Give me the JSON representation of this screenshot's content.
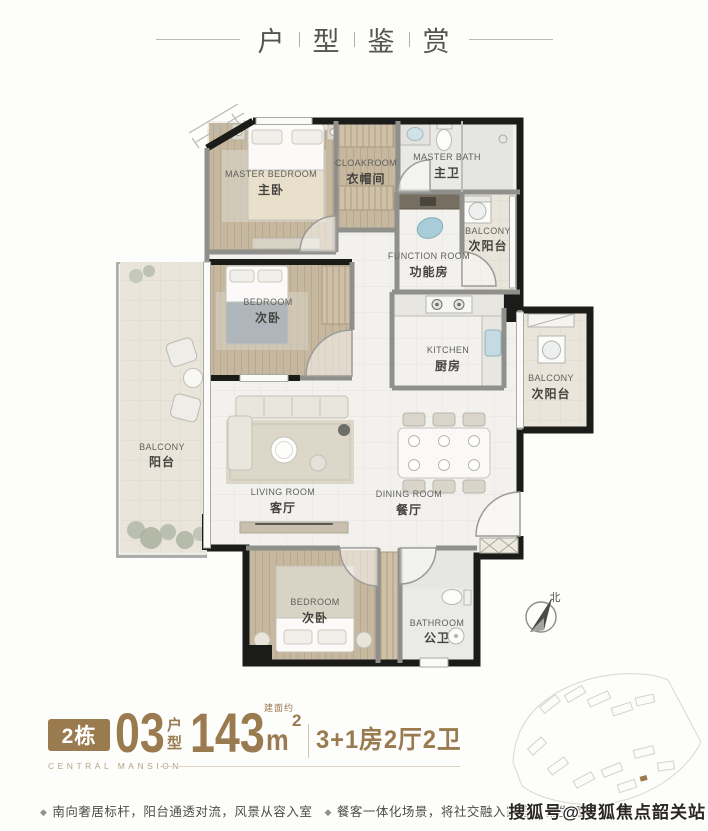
{
  "header": {
    "title_chars": [
      "户",
      "型",
      "鉴",
      "赏"
    ]
  },
  "plan": {
    "rooms": [
      {
        "en": "MASTER BEDROOM",
        "cn": "主卧"
      },
      {
        "en": "CLOAKROOM",
        "cn": "衣帽间"
      },
      {
        "en": "MASTER BATH",
        "cn": "主卫"
      },
      {
        "en": "BALCONY",
        "cn": "次阳台"
      },
      {
        "en": "FUNCTION ROOM",
        "cn": "功能房"
      },
      {
        "en": "BEDROOM",
        "cn": "次卧"
      },
      {
        "en": "KITCHEN",
        "cn": "厨房"
      },
      {
        "en": "BALCONY",
        "cn": "次阳台"
      },
      {
        "en": "BALCONY",
        "cn": "阳台"
      },
      {
        "en": "LIVING ROOM",
        "cn": "客厅"
      },
      {
        "en": "DINING ROOM",
        "cn": "餐厅"
      },
      {
        "en": "BEDROOM",
        "cn": "次卧"
      },
      {
        "en": "BATHROOM",
        "cn": "公卫"
      }
    ],
    "compass_label": "北"
  },
  "info": {
    "building": "2栋",
    "unit_no": "03",
    "unit_label": "户型",
    "area_note": "建面约",
    "area_number": "143",
    "area_unit": "m",
    "area_sup": "2",
    "spec": "3+1房2厅2卫",
    "brand": "CENTRAL MANSION"
  },
  "features": {
    "bullet": "◆",
    "items": [
      "南向奢居标杆，阳台通透对流，风景从容入室",
      "餐客一体化场景，将社交融入家庭日常生活"
    ]
  },
  "watermark": {
    "text": "搜狐号@搜狐焦点韶关站"
  },
  "colors": {
    "accent": "#9a7a4f",
    "wall": "#1b1b19",
    "wood": "#c6b79f",
    "tile": "#f2f1ee",
    "balcony_floor": "#e9e5da"
  }
}
